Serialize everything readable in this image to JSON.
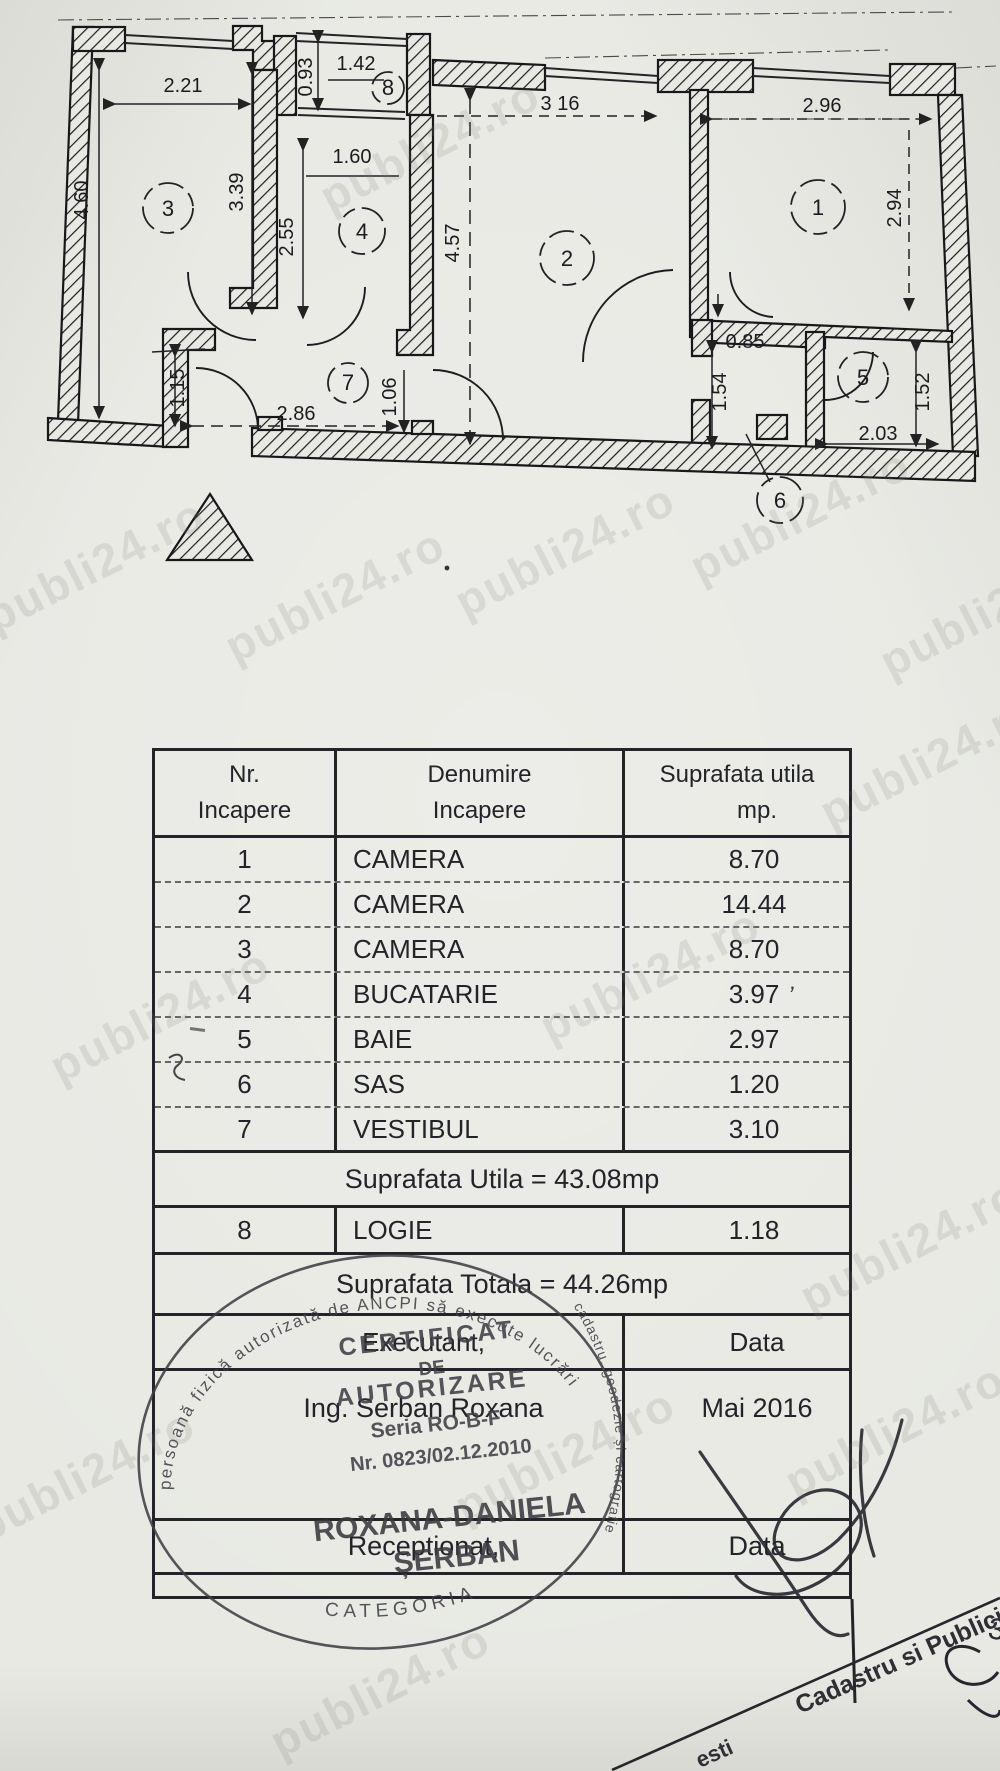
{
  "watermark": {
    "text": "publi24.ro"
  },
  "plan": {
    "rooms": {
      "r1": "1",
      "r2": "2",
      "r3": "3",
      "r4": "4",
      "r5": "5",
      "r6": "6",
      "r7": "7",
      "r8": "8"
    },
    "dims": {
      "d221": "2.21",
      "d093": "0.93",
      "d142": "1.42",
      "d316": "3 16",
      "d296": "2.96",
      "d160": "1.60",
      "d339": "3.39",
      "d255": "2.55",
      "d460": "4.60",
      "d457": "4.57",
      "d294": "2.94",
      "d085": "0.85",
      "d154": "1.54",
      "d152": "1.52",
      "d203": "2.03",
      "d286": "2.86",
      "d115": "1.15",
      "d106": "1.06"
    }
  },
  "table": {
    "header": {
      "col1_line1": "Nr.",
      "col1_line2": "Incapere",
      "col2_line1": "Denumire",
      "col2_line2": "Incapere",
      "col3_line1": "Suprafata utila",
      "col3_line2": "mp."
    },
    "rows": [
      {
        "nr": "1",
        "name": "CAMERA",
        "area": "8.70"
      },
      {
        "nr": "2",
        "name": "CAMERA",
        "area": "14.44"
      },
      {
        "nr": "3",
        "name": "CAMERA",
        "area": "8.70"
      },
      {
        "nr": "4",
        "name": "BUCATARIE",
        "area": "3.97"
      },
      {
        "nr": "5",
        "name": "BAIE",
        "area": "2.97"
      },
      {
        "nr": "6",
        "name": "SAS",
        "area": "1.20"
      },
      {
        "nr": "7",
        "name": "VESTIBUL",
        "area": "3.10"
      }
    ],
    "utila_total": "Suprafata Utila = 43.08mp",
    "logie_row": {
      "nr": "8",
      "name": "LOGIE",
      "area": "1.18"
    },
    "totala": "Suprafata Totala = 44.26mp",
    "executant_label": "Executant,",
    "executant_data_label": "Data",
    "executant_name": "Ing. Serban Roxana",
    "executant_date": "Mai 2016",
    "receptionat_label": "Receptionat,",
    "receptionat_data_label": "Data"
  },
  "stamp": {
    "ring_top": "persoană fizică autorizată de ANCPI să execute lucrări",
    "ring_right": "cadastru, geodezie și cartografie",
    "ring_bottom": "CATEGORIA",
    "line1": "CERTIFICAT",
    "line2": "DE",
    "line3": "AUTORIZARE",
    "seria": "Seria RO-B-F",
    "nr": "Nr. 0823/02.12.2010",
    "name1": "ROXANA-DANIELA",
    "name2": "ȘERBAN"
  },
  "footer": {
    "fragment1": "Cadastru si Publicitate Imobili",
    "fragment2": "esti",
    "page_number": "3"
  }
}
